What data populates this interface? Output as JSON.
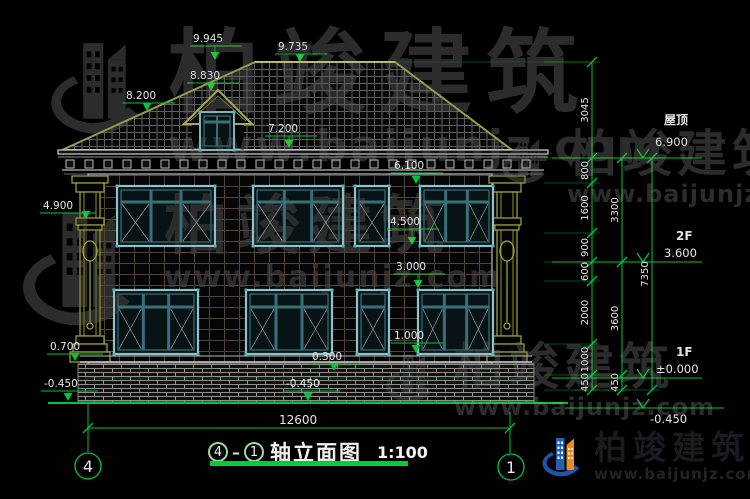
{
  "drawing": {
    "title": {
      "axis_start": "4",
      "axis_end": "1",
      "name": "轴立面图",
      "scale": "1:100"
    }
  },
  "watermark": {
    "brand": "柏竣建筑",
    "site": "www.baijunjz.com"
  },
  "brand": {
    "name": "柏竣建筑",
    "site": "www.baijunjz.com"
  },
  "colors": {
    "dim_green": "#00c43c",
    "dim_text": "#e6e6e6",
    "roof_edge": "#9a9a4e",
    "column_yellow": "#a8a838",
    "window_teal": "#8fc2ca",
    "title_underline": "#00cd36"
  },
  "annotations": {
    "elevation_marks": [
      {
        "t": "9.945",
        "x": 193,
        "y": 42,
        "u": [
          190,
          242,
          46
        ],
        "a": [
          215,
          60
        ]
      },
      {
        "t": "9.735",
        "x": 278,
        "y": 50,
        "u": [
          275,
          327,
          54
        ],
        "a": [
          300,
          62
        ]
      },
      {
        "t": "8.830",
        "x": 190,
        "y": 79,
        "u": [
          187,
          239,
          83
        ],
        "a": [
          211,
          91
        ]
      },
      {
        "t": "8.200",
        "x": 126,
        "y": 99,
        "u": [
          123,
          175,
          103
        ],
        "a": [
          147,
          111
        ]
      },
      {
        "t": "7.200",
        "x": 268,
        "y": 132,
        "u": [
          265,
          317,
          136
        ],
        "a": [
          289,
          148
        ]
      },
      {
        "t": "6.100",
        "x": 394,
        "y": 169,
        "u": [
          391,
          443,
          173
        ],
        "a": [
          416,
          184
        ]
      },
      {
        "t": "4.900",
        "x": 43,
        "y": 209,
        "u": [
          40,
          96,
          213
        ],
        "a": [
          86,
          219
        ]
      },
      {
        "t": "4.500",
        "x": 390,
        "y": 225,
        "u": [
          387,
          439,
          229
        ],
        "a": [
          412,
          245
        ]
      },
      {
        "t": "3.000",
        "x": 396,
        "y": 270,
        "u": [
          393,
          445,
          274
        ],
        "a": [
          418,
          288
        ]
      },
      {
        "t": "1.000",
        "x": 394,
        "y": 339,
        "u": [
          391,
          443,
          343
        ],
        "a": [
          416,
          353
        ]
      },
      {
        "t": "0.700",
        "x": 50,
        "y": 350,
        "u": [
          47,
          103,
          354
        ],
        "a": [
          75,
          361
        ]
      },
      {
        "t": "0.300",
        "x": 312,
        "y": 360,
        "u": [
          309,
          361,
          364
        ],
        "a": [
          334,
          371
        ]
      },
      {
        "t": "-0.450",
        "x": 286,
        "y": 387,
        "u": [
          283,
          340,
          391
        ],
        "a": [
          308,
          401
        ]
      },
      {
        "t": "-0.450",
        "x": 44,
        "y": 387,
        "u": [
          41,
          98,
          391
        ],
        "a": [
          68,
          401
        ]
      }
    ],
    "levels": [
      {
        "label": "屋顶",
        "value": "6.900",
        "y": 158,
        "line": [
          552,
          702
        ],
        "vx": 643,
        "lp": [
          664,
          124
        ],
        "vp": [
          655,
          146
        ]
      },
      {
        "label": "2F",
        "value": "3.600",
        "y": 262,
        "line": [
          552,
          702
        ],
        "vx": 643,
        "lp": [
          676,
          240
        ],
        "vp": [
          664,
          257
        ]
      },
      {
        "label": "1F",
        "value": "±0.000",
        "y": 378,
        "line": [
          552,
          702
        ],
        "vx": 643,
        "lp": [
          676,
          356
        ],
        "vp": [
          656,
          373
        ]
      },
      {
        "label": "",
        "value": "-0.450",
        "y": 408,
        "line": [
          565,
          724
        ],
        "vx": 643,
        "lp": [
          0,
          0
        ],
        "vp": [
          650,
          423
        ]
      }
    ],
    "chains": [
      {
        "x": 592,
        "segs": [
          [
            "3045",
            62,
            158
          ],
          [
            "800",
            158,
            183
          ],
          [
            "1600",
            183,
            233
          ],
          [
            "900",
            233,
            262
          ],
          [
            "600",
            262,
            281
          ],
          [
            "2000",
            281,
            344
          ],
          [
            "1000",
            344,
            375
          ],
          [
            "450",
            375,
            390
          ]
        ]
      },
      {
        "x": 622,
        "segs": [
          [
            "3300",
            158,
            262
          ],
          [
            "3600",
            262,
            375
          ],
          [
            "450",
            375,
            390
          ]
        ]
      },
      {
        "x": 652,
        "segs": [
          [
            "7350",
            158,
            390
          ]
        ]
      }
    ],
    "bottom_dim": {
      "value": "12600",
      "y": 428,
      "x1": 88,
      "x2": 510,
      "tp": [
        279,
        424
      ],
      "ext": [
        [
          88,
          404,
          452
        ],
        [
          510,
          412,
          453
        ]
      ]
    },
    "axis_bubbles": [
      {
        "n": "4",
        "cx": 88,
        "cy": 466
      },
      {
        "n": "1",
        "cx": 511,
        "cy": 467
      }
    ]
  }
}
